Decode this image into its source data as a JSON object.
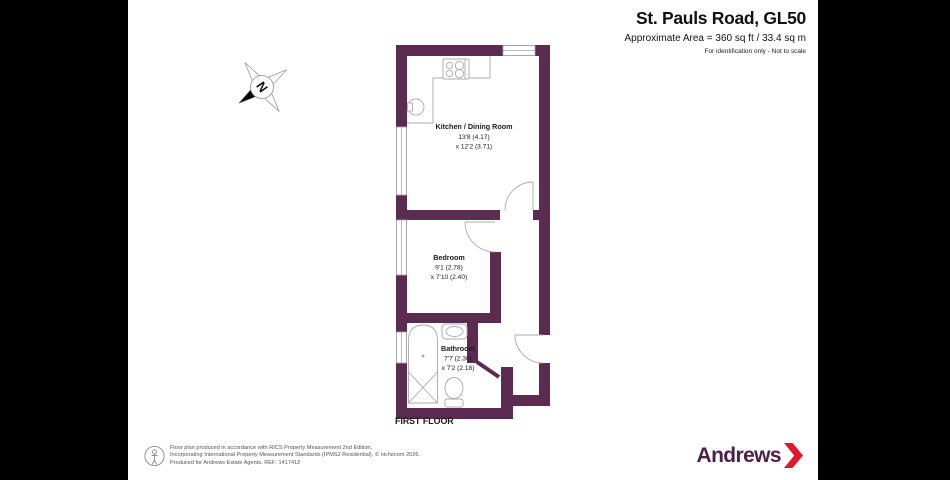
{
  "header": {
    "title": "St. Pauls Road, GL50",
    "area": "Approximate Area = 360 sq ft / 33.4 sq m",
    "note": "For identification only - Not to scale"
  },
  "plan": {
    "first_floor_label": "FIRST FLOOR",
    "rooms": [
      {
        "name": "Kitchen / Dining Room",
        "dim1": "13'8 (4.17)",
        "dim2": "x 12'2 (3.71)"
      },
      {
        "name": "Bedroom",
        "dim1": "9'1 (2.78)",
        "dim2": "x 7'10 (2.40)"
      },
      {
        "name": "Bathroom",
        "dim1": "7'7 (2.30)",
        "dim2": "x 7'2 (2.18)"
      }
    ]
  },
  "compass": {
    "letter": "N"
  },
  "footer": {
    "line1": "Floor plan produced in accordance with RICS Property Measurement 2nd Edition,",
    "line2": "Incorporating International Property Measurement Standards (IPMS2 Residential).    © nichecom 2026.",
    "line3": "Produced for Andrews Estate Agents.    REF: 1417412"
  },
  "brand": {
    "name": "Andrews"
  },
  "colors": {
    "wall": "#5b2b51",
    "brand_purple": "#4b2145",
    "brand_red": "#e0182d",
    "hairline": "#a8a8a8"
  }
}
